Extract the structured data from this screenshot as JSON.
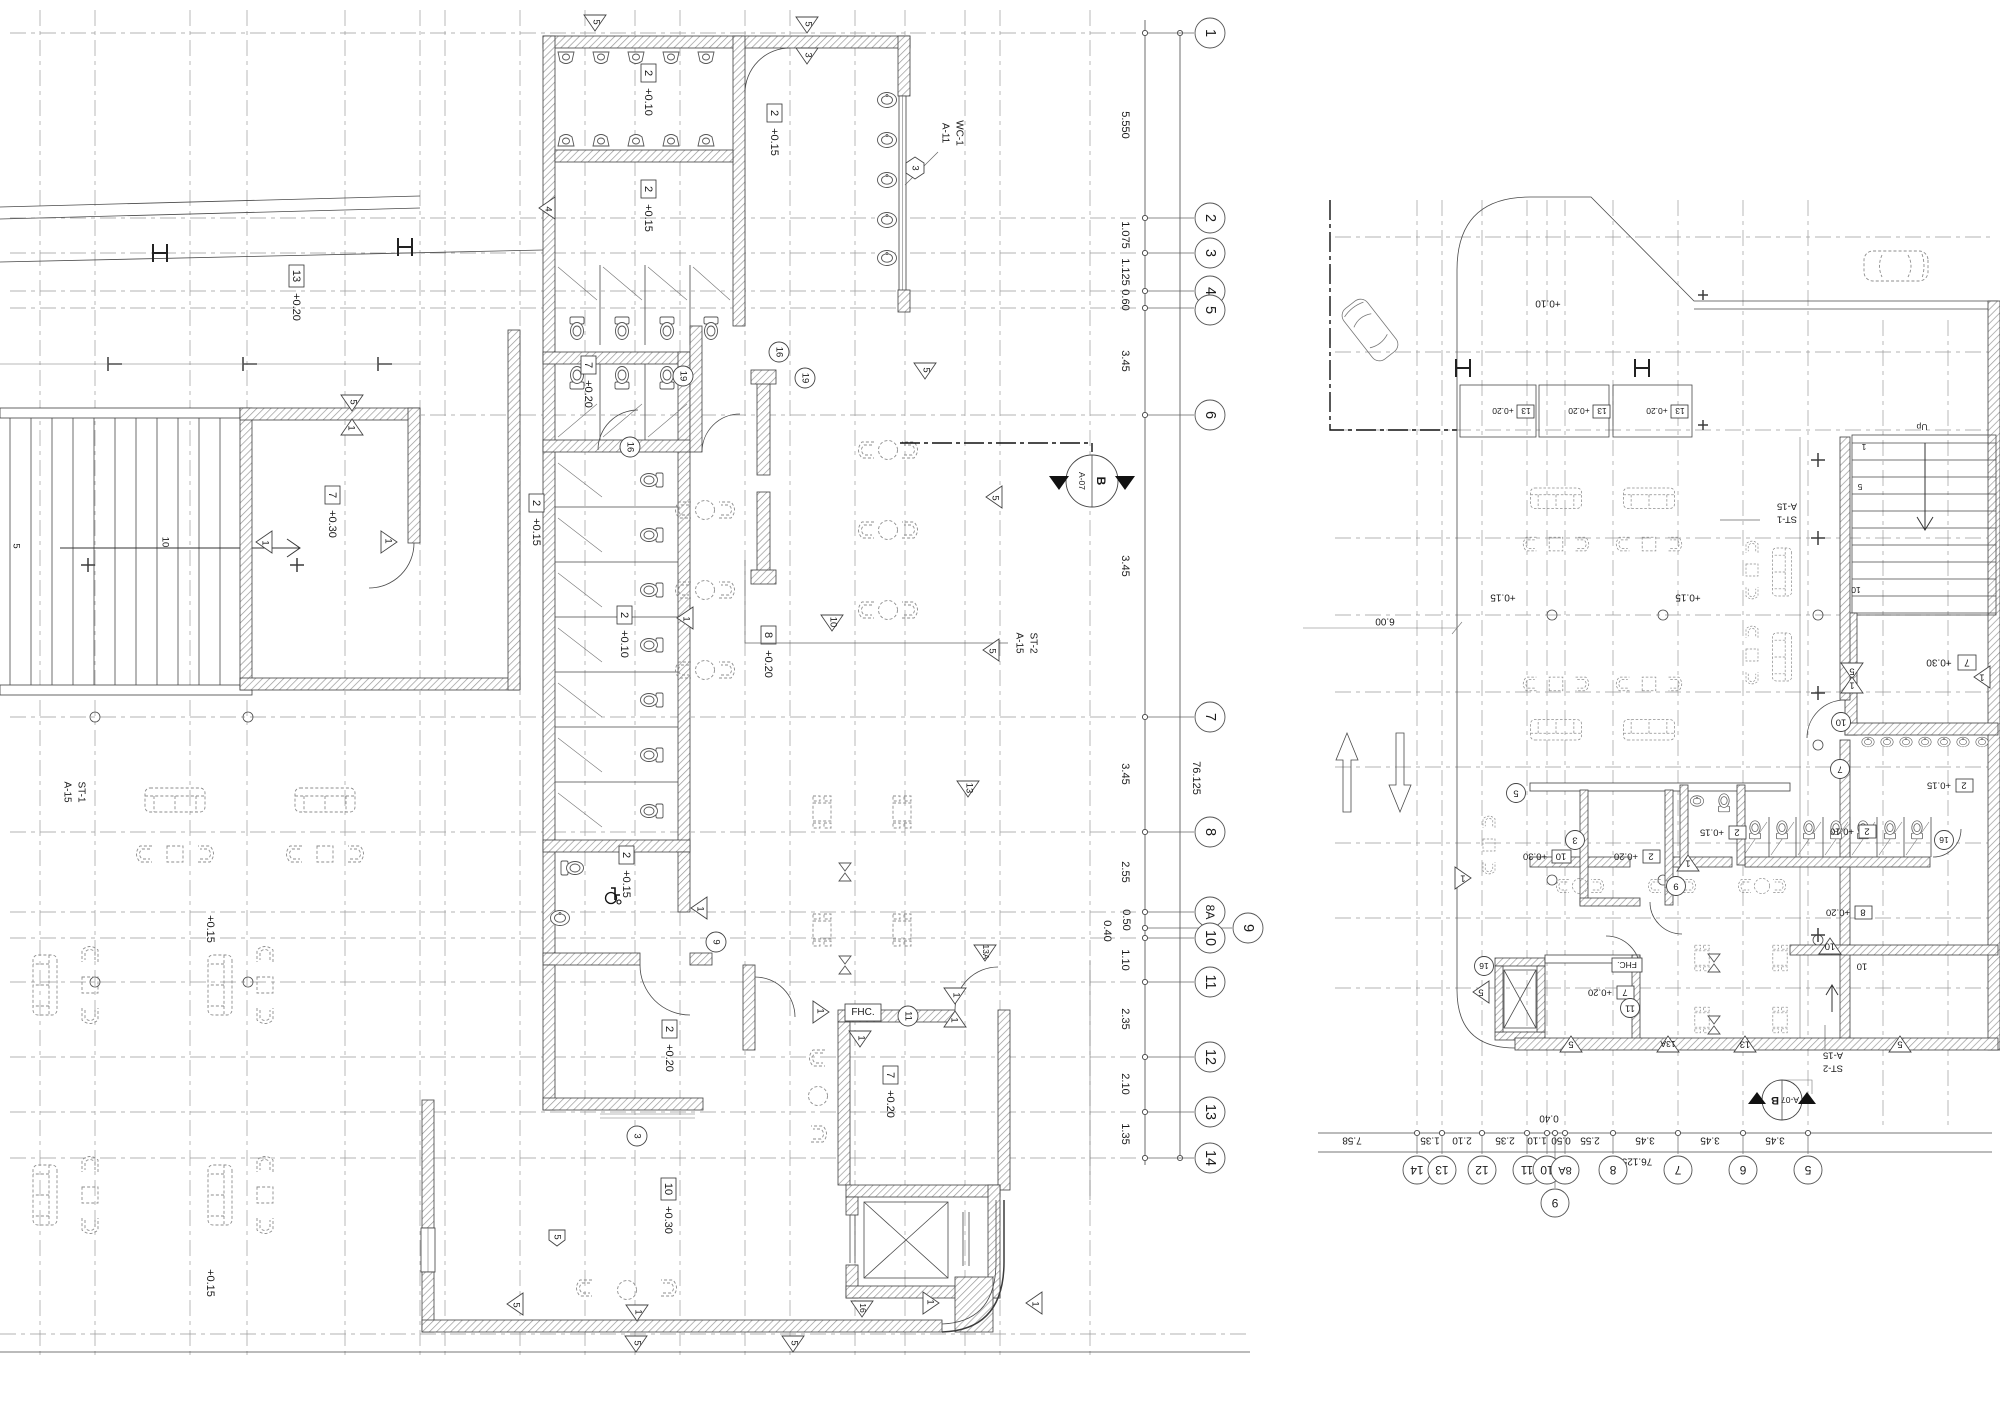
{
  "drawing": {
    "refs": {
      "wc_tag": "WC-1",
      "wc_sheet": "A-11",
      "st1_tag": "ST-1",
      "st2_tag": "ST-2",
      "stair_sheet": "A-15",
      "section_letter": "B",
      "section_sheet": "A-07",
      "fhc": "FHC.",
      "up": "Up"
    },
    "levels": {
      "u1": {
        "n": "2",
        "v": "+0.10"
      },
      "u2": {
        "n": "2",
        "v": "+0.15"
      },
      "u3": {
        "n": "13",
        "v": "+0.20"
      },
      "u4": {
        "n": "7",
        "v": "+0.30"
      },
      "u5": {
        "n": "7",
        "v": "+0.20"
      },
      "u6": {
        "n": "8",
        "v": "+0.20"
      },
      "u7": {
        "n": "2",
        "v": "+0.20"
      },
      "u8": {
        "n": "10",
        "v": "+0.30"
      },
      "p15": "+0.15",
      "p10": "+0.10"
    },
    "tags": {
      "t1": "1",
      "t3": "3",
      "t4": "4",
      "t5": "5",
      "t7": "7",
      "t9": "9",
      "t10": "10",
      "t11": "11",
      "t13": "13",
      "t13a": "13A",
      "t16": "16",
      "t19": "19"
    },
    "stair_numbers": {
      "s1": "1",
      "s5": "5",
      "s10": "10"
    },
    "grid_left": {
      "bubbles": [
        "1",
        "2",
        "3",
        "4",
        "5",
        "6",
        "7",
        "8",
        "8A",
        "9",
        "10",
        "11",
        "12",
        "13",
        "14"
      ],
      "dims": [
        "5.550",
        "1.075",
        "1.125",
        "0.60",
        "3.45",
        "3.45",
        "3.45",
        "2.55",
        "0.50",
        "0.40",
        "1.10",
        "2.35",
        "2.10",
        "1.35"
      ],
      "total": "76.125"
    },
    "grid_right": {
      "bubbles": [
        "14",
        "13",
        "12",
        "11",
        "10",
        "8A",
        "9",
        "8",
        "7",
        "6",
        "5"
      ],
      "dims": [
        "7.58",
        "1.35",
        "2.10",
        "2.35",
        "1.10",
        "0.40",
        "0.50",
        "2.55",
        "3.45",
        "3.45",
        "3.45"
      ],
      "total": "76.125",
      "offset": "6.00"
    }
  }
}
